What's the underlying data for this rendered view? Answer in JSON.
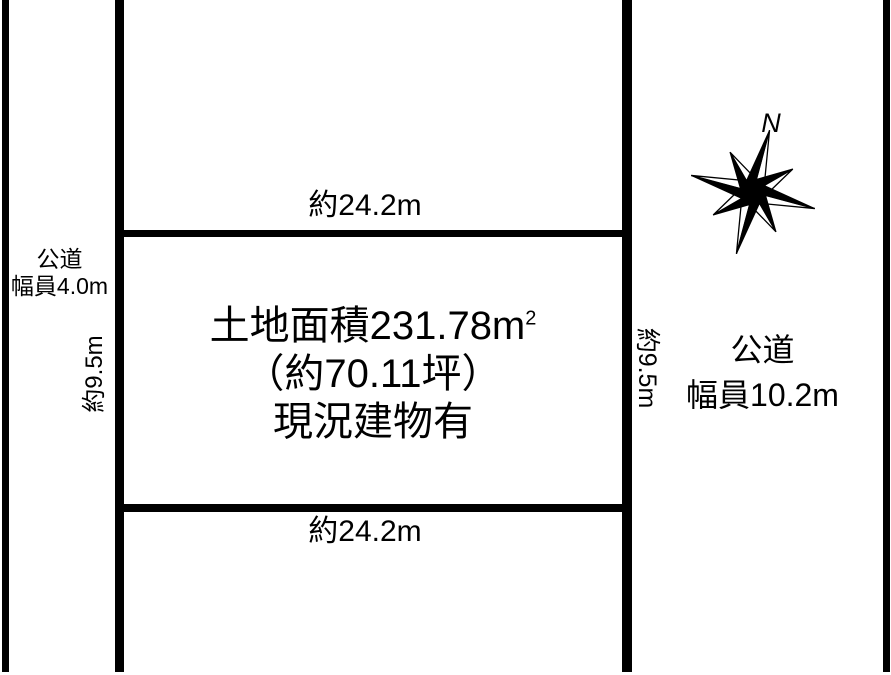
{
  "diagram": {
    "parcel": {
      "area_text": "土地面積231.78m",
      "area_superscript": "2",
      "tsubo_text": "（約70.11坪）",
      "status_text": "現況建物有",
      "width_top": "約24.2m",
      "width_bottom": "約24.2m",
      "depth_left": "約9.5m",
      "depth_right": "約9.5m"
    },
    "road_left": {
      "type": "公道",
      "width": "幅員4.0m"
    },
    "road_right": {
      "type": "公道",
      "width": "幅員10.2m"
    },
    "compass": {
      "north": "N"
    },
    "colors": {
      "line": "#000000",
      "background": "#ffffff",
      "text": "#000000"
    }
  }
}
